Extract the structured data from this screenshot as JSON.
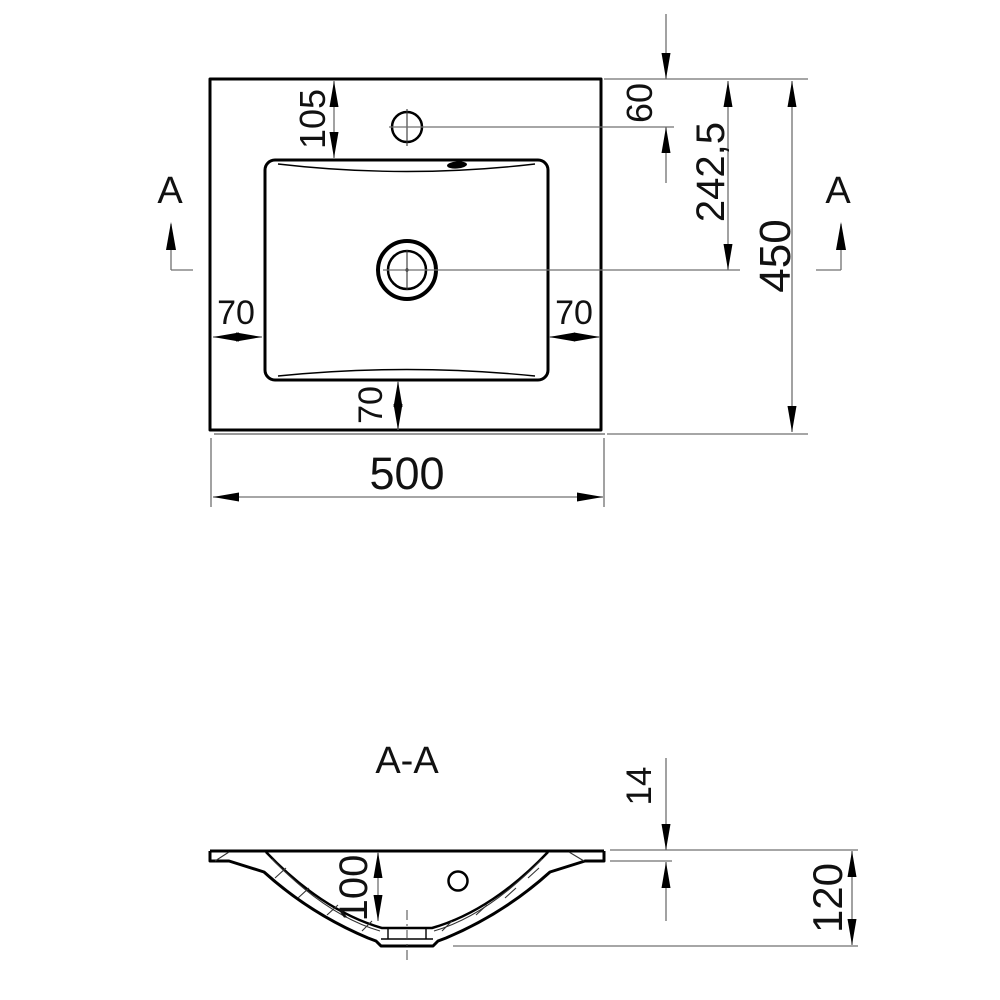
{
  "top_view": {
    "dims": {
      "overall_width": "500",
      "overall_depth": "450",
      "basin_top_offset": "105",
      "faucet_hole_offset": "60",
      "drain_center_offset": "242,5",
      "inset_left": "70",
      "inset_right": "70",
      "inset_bottom": "70"
    },
    "section_marker_left": "A",
    "section_marker_right": "A"
  },
  "section_view": {
    "title": "A-A",
    "dims": {
      "countertop_thickness": "14",
      "basin_inner_depth": "100",
      "overall_height": "120"
    }
  },
  "colors": {
    "object_line": "#000000",
    "dimension_line": "#707070",
    "background": "#ffffff"
  }
}
